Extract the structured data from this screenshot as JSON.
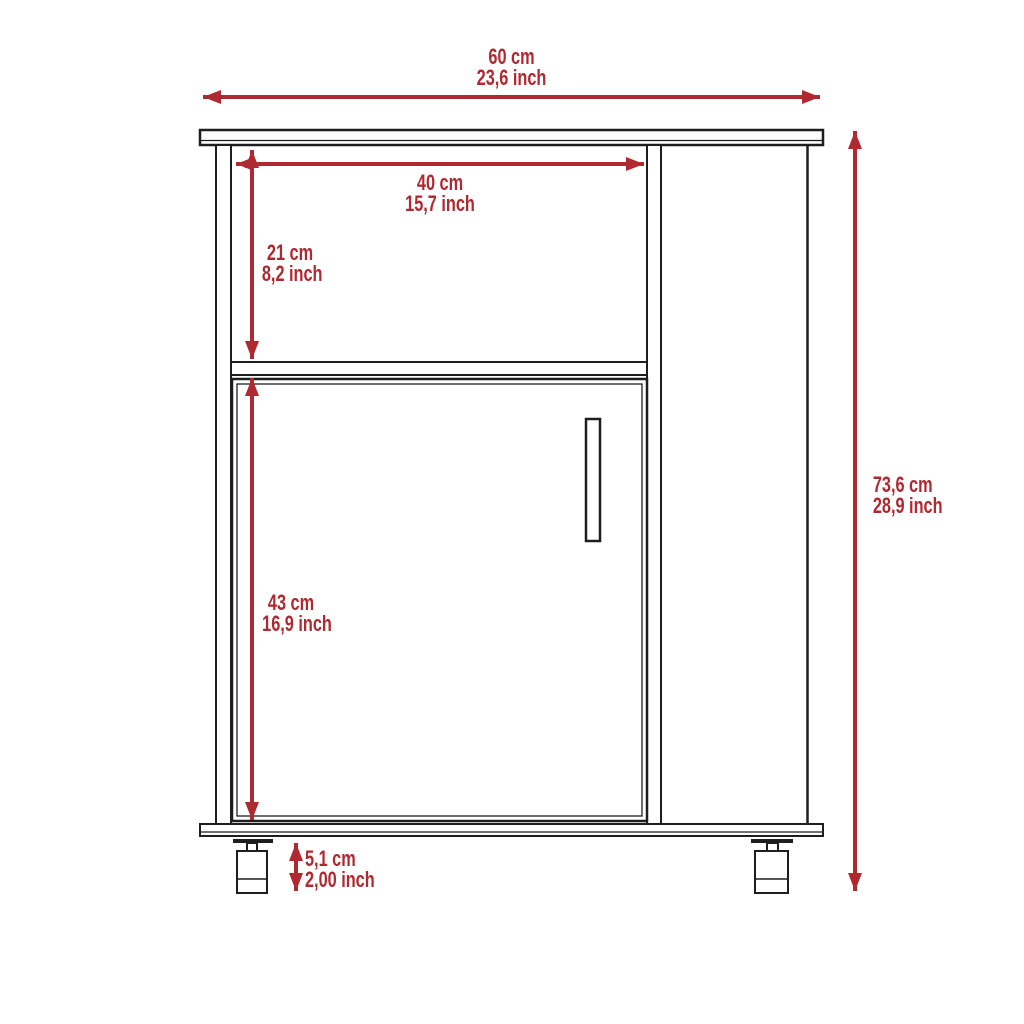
{
  "diagram": {
    "type": "furniture-dimension-drawing",
    "subject": "kitchen cabinet with open compartment, single door and casters"
  },
  "colors": {
    "dimension": "#b02830",
    "line": "#1e1e1e",
    "background": "#ffffff"
  },
  "dimensions": {
    "overall_width": {
      "cm": "60 cm",
      "inch": "23,6 inch"
    },
    "compartment_width": {
      "cm": "40 cm",
      "inch": "15,7 inch"
    },
    "compartment_height": {
      "cm": "21 cm",
      "inch": "8,2 inch"
    },
    "door_height": {
      "cm": "43 cm",
      "inch": "16,9 inch"
    },
    "overall_height": {
      "cm": "73,6 cm",
      "inch": "28,9 inch"
    },
    "leg_height": {
      "cm": "5,1 cm",
      "inch": "2,00 inch"
    }
  }
}
